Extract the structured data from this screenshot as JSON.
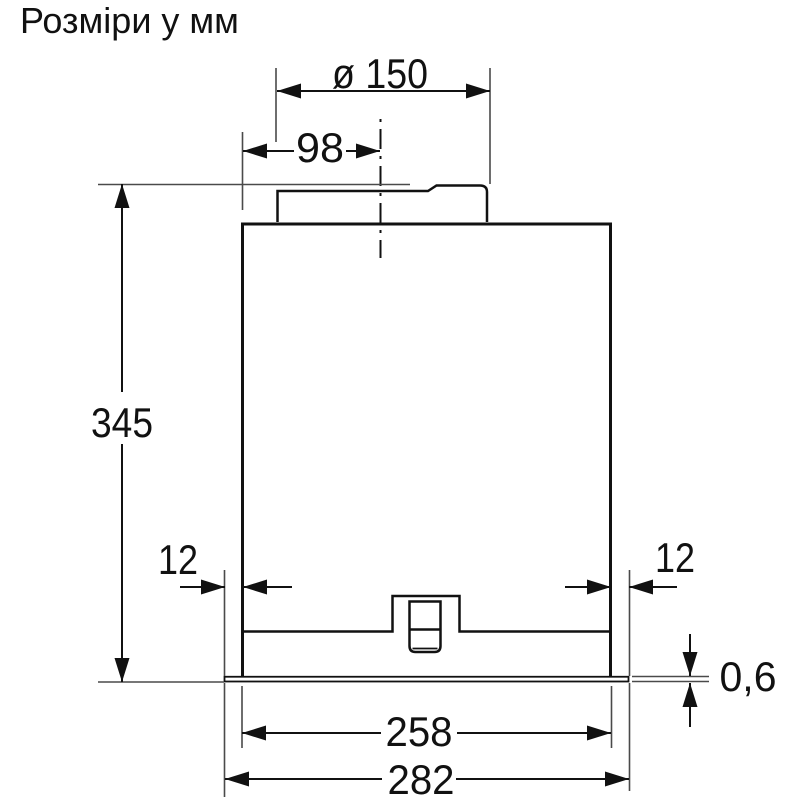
{
  "title": "Розміри у мм",
  "diagram": {
    "type": "technical-dimension-drawing",
    "line_color": "#111111",
    "background": "#ffffff",
    "labels": {
      "duct_diameter": "ø 150",
      "duct_offset": "98",
      "height": "345",
      "flange_left": "12",
      "flange_right": "12",
      "panel_thickness": "0,6",
      "inner_width": "258",
      "overall_width": "282"
    }
  }
}
